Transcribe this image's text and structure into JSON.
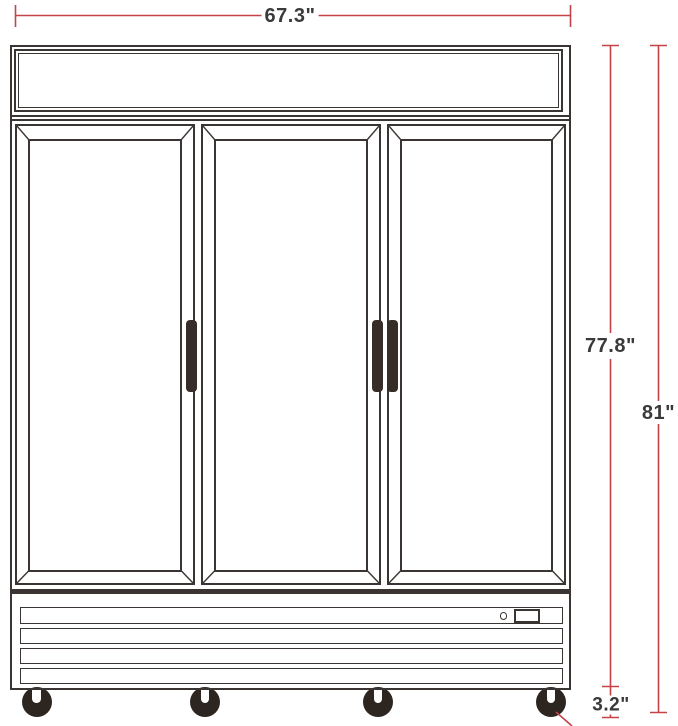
{
  "dimensions": {
    "width_label": "67.3\"",
    "cabinet_height_label": "77.8\"",
    "overall_height_label": "81\"",
    "caster_height_label": "3.2\""
  },
  "colors": {
    "background": "#ffffff",
    "outline": "#3a3532",
    "dimension_line": "#c64249",
    "label_text": "#3a3a3a",
    "door_handle": "#362c28",
    "caster": "#2d2520"
  }
}
